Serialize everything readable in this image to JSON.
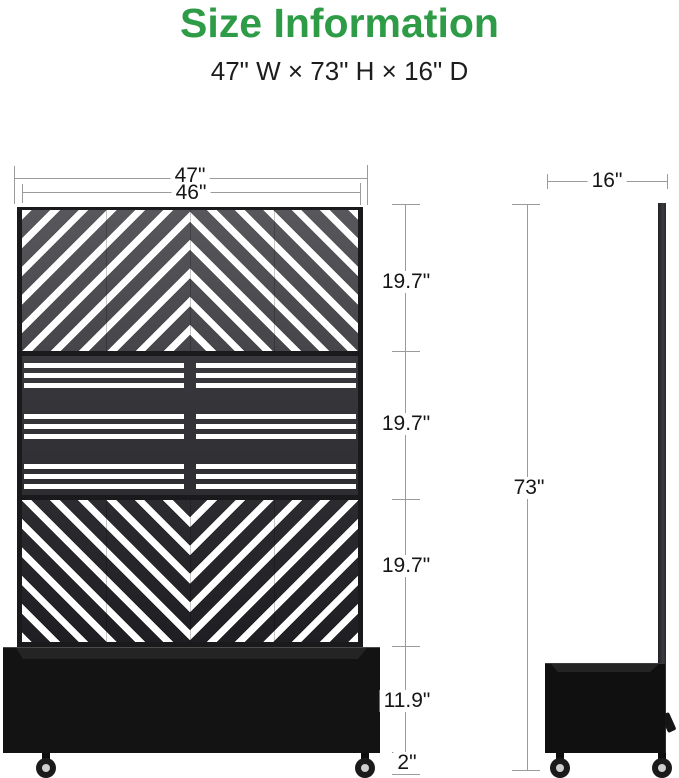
{
  "page": {
    "title": "Size Information",
    "subtitle": "47\" W × 73\" H × 16\" D"
  },
  "colors": {
    "title_green": "#2e9b46",
    "dimension_line": "#9b9b9b",
    "product_black": "#1a1a1d"
  },
  "front_view": {
    "labels": {
      "outer_width": "47\"",
      "panel_width": "46\"",
      "panel1_height": "19.7\"",
      "panel2_height": "19.7\"",
      "panel3_height": "19.7\"",
      "planter_height": "11.9\"",
      "caster_height": "2\""
    }
  },
  "side_view": {
    "labels": {
      "depth": "16\"",
      "total_height": "73\""
    }
  }
}
